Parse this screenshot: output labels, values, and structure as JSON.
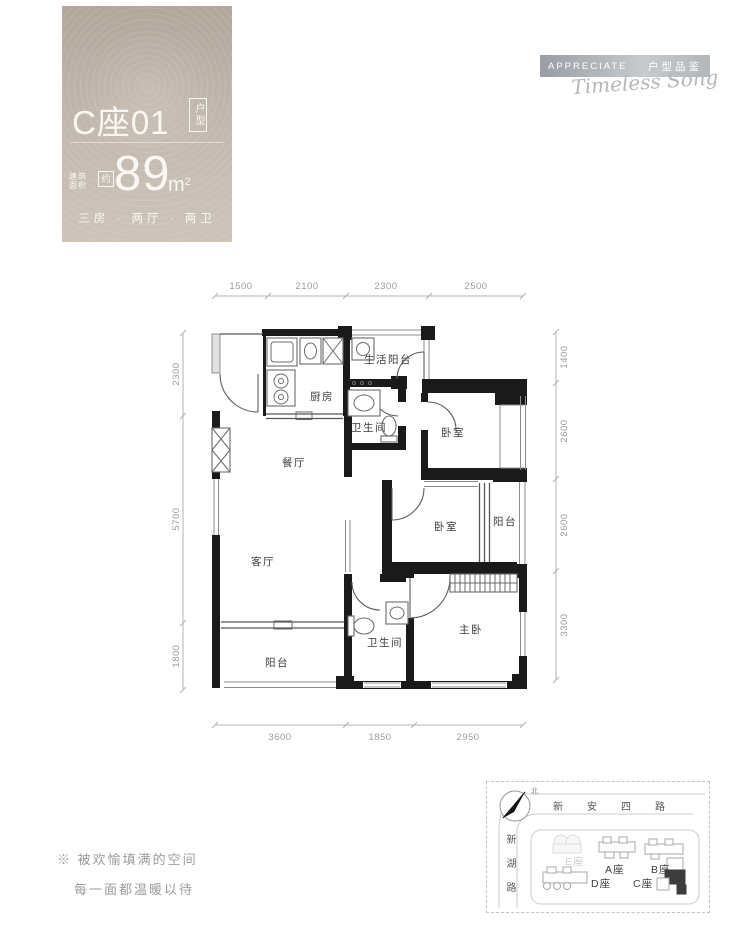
{
  "card": {
    "unit": "C座01",
    "unit_tag": "户型",
    "area_prefix_l1": "建筑",
    "area_prefix_l2": "面积",
    "area_approx": "约",
    "area_value": "89",
    "area_unit_m": "m",
    "area_unit_sup": "2",
    "layout": "三房 · 两厅 · 两卫"
  },
  "brand": {
    "en": "APPRECIATE",
    "cn": "户型品鉴",
    "signature": "Timeless Song"
  },
  "plan": {
    "rooms": [
      {
        "label": "生活阳台"
      },
      {
        "label": "厨房"
      },
      {
        "label": "卫生间"
      },
      {
        "label": "卧室"
      },
      {
        "label": "餐厅"
      },
      {
        "label": "卧室"
      },
      {
        "label": "阳台"
      },
      {
        "label": "客厅"
      },
      {
        "label": "主卧"
      },
      {
        "label": "卫生间"
      },
      {
        "label": "阳台"
      }
    ],
    "dims_top": [
      "1500",
      "2100",
      "2300",
      "2500"
    ],
    "dims_bottom": [
      "3600",
      "1850",
      "2950"
    ],
    "dims_left": [
      "2300",
      "5700",
      "1800"
    ],
    "dims_right": [
      "1400",
      "2600",
      "2600",
      "3300"
    ]
  },
  "tagline": {
    "line1": "※ 被欢愉填满的空间",
    "line2": "每一面都温暖以待"
  },
  "map": {
    "north": "北",
    "road_top": "新安四路",
    "road_left": "新湖路",
    "buildings": [
      {
        "label": "E座"
      },
      {
        "label": "A座"
      },
      {
        "label": "B座"
      },
      {
        "label": "D座"
      },
      {
        "label": "C座"
      }
    ]
  }
}
